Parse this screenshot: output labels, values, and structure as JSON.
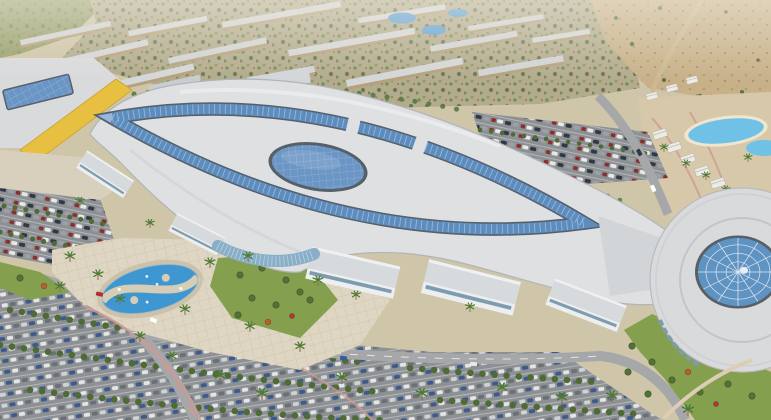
{
  "meta": {
    "type": "3d-architectural-aerial-rendering",
    "subject": "Shopping mall and mixed-use resort development masterplan, aerial view",
    "render_width": 771,
    "render_height": 420
  },
  "scene": {
    "description": "Bird's-eye architectural rendering: an organic-shaped white mall roof with a pointed-oval blue skylight ring and central elliptical skylight, a yellow-walled anchor store at left, a circular pavilion with radial glazed dome at right, fountain plaza with palm trees, large tree-lined surface parking lots full of cars, lagoon-style resort pools with villas at right, rows of low-rise retail/residential strips behind, and undeveloped desert land at top right.",
    "palette": {
      "base_sand": "#cfc5a8",
      "field_green": "#9aa06d",
      "village_ground": "#b3ab8e",
      "desert_sand": "#c8b189",
      "roof_white": "#dfe0e2",
      "roof_shade": "#c6cacd",
      "skylight_blue": "#5d8cbe",
      "skylight_rim": "#566069",
      "glass_blue": "#6b95c4",
      "yellow_wall": "#e7bf41",
      "dome_glass": "#5f93c2",
      "plaza_paver": "#ded6c2",
      "lawn_green": "#84a04f",
      "tree_green": "#527335",
      "palm_green": "#4d7a33",
      "asphalt": "#8e9194",
      "road_gray": "#a5a7a9",
      "path_pink": "#cf9a94",
      "pool_blue": "#3f97d2",
      "lagoon_blue": "#6fc2e6",
      "lake_blue": "#5d9fd4"
    },
    "features": [
      {
        "name": "central-mall",
        "description": "Organic curved white roof with pointed-oval skylight ring, bridge breaks, and central elliptical glass skylight"
      },
      {
        "name": "anchor-store",
        "description": "Box building with yellow facade band and long rectangular rooftop skylight, left side"
      },
      {
        "name": "dome-pavilion",
        "description": "Circular building with radial-spoke glazed blue dome, right side"
      },
      {
        "name": "entrance-rotunda",
        "description": "Curved glass curtain-wall entrance facing the fountain plaza"
      },
      {
        "name": "fountain-plaza",
        "description": "Paved plaza with twin-crescent elliptical fountain pools and palm trees"
      },
      {
        "name": "parking-lots",
        "description": "Surface parking with white-striped rows of multicolored cars and tree lines"
      },
      {
        "name": "retail-strips",
        "description": "Long wavy single-storey strip buildings north-east of the mall"
      },
      {
        "name": "resort-pools",
        "description": "Lagoon-style swimming pools with rows of white villas and palms"
      },
      {
        "name": "background-district",
        "description": "Rows of low-rise buildings with greenery and small blue ponds"
      },
      {
        "name": "desert-land",
        "description": "Sandy undeveloped terrain with scrub trees, top right corner"
      }
    ]
  }
}
